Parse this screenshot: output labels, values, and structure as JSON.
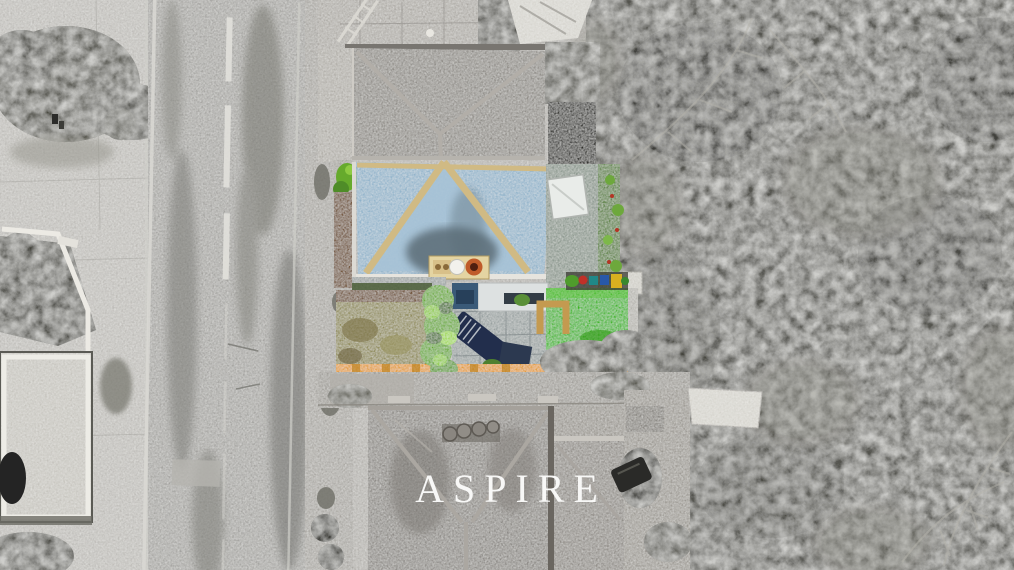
{
  "watermark": {
    "text": "ASPIRE"
  },
  "scene": {
    "colors": {
      "watermark_white": "#fbfbfa",
      "roof_blue": "#8fb2ca",
      "roof_blue_light": "#a6c2d6",
      "ridge_tan": "#d0ba84",
      "eaves_white": "#e6e4de",
      "chimney_cream": "#e4d4a2",
      "pot_terracotta": "#bf5b2a",
      "lawn_green": "#38b618",
      "hedge_green": "#66aa2c",
      "dried_lawn_olive": "#8e8954",
      "bark_brown": "#6e4e2e",
      "boundary_orange": "#e29a1e",
      "lounger_navy": "#222e4c",
      "planter_tan": "#c49a50",
      "vine_green": "#57803a"
    }
  }
}
